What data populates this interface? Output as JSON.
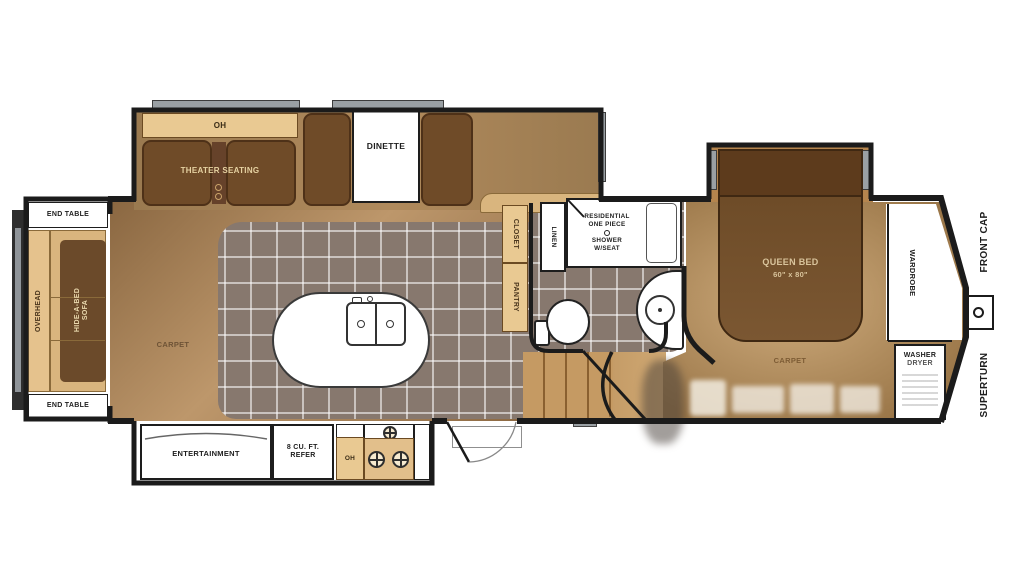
{
  "diagram_type": "rv-fifth-wheel-floorplan",
  "labels": {
    "rear_slide": {
      "end_table_top": "END TABLE",
      "overhead": "OVERHEAD",
      "sofa_l1": "HIDE-A-BED",
      "sofa_l2": "SOFA",
      "end_table_bottom": "END TABLE"
    },
    "theater_slide": {
      "oh": "OH",
      "theater_seating": "THEATER SEATING",
      "dinette": "DINETTE"
    },
    "living": {
      "carpet": "CARPET",
      "closet": "CLOSET",
      "pantry": "PANTRY"
    },
    "kitchen_slide": {
      "entertainment": "ENTERTAINMENT",
      "refer_l1": "8 CU. FT.",
      "refer_l2": "REFER",
      "oh": "OH"
    },
    "bath": {
      "linen": "LINEN",
      "shower_l1": "RESIDENTIAL",
      "shower_l2": "ONE PIECE",
      "shower_l3": "SHOWER",
      "shower_l4": "W/SEAT"
    },
    "bedroom": {
      "queen_bed": "QUEEN BED",
      "queen_size": "60\" x 80\"",
      "carpet": "CARPET",
      "wardrobe": "WARDROBE",
      "washer_l1": "WASHER",
      "washer_l2": "DRYER"
    },
    "exterior": {
      "front_cap": "FRONT CAP",
      "superturn": "SUPERTURN"
    }
  },
  "icons": {
    "kingpin": "kingpin-hitch-icon",
    "sink": "double-sink-icon",
    "burners": "stove-burner-icon",
    "toilet": "toilet-icon",
    "vanity_sink": "round-sink-icon",
    "shower_drain": "shower-drain-icon"
  },
  "colors": {
    "wall": "#1b1b1b",
    "tile_floor": "#87786e",
    "grout": "#ffffff",
    "carpet_light": "#c3a077",
    "carpet_dark": "#8f6c44",
    "dark_wood_furniture": "#6f4b28",
    "cabinet_tan": "#e9c992",
    "slide_floor": "#a9845a",
    "window_gray": "#9aa0a4"
  }
}
